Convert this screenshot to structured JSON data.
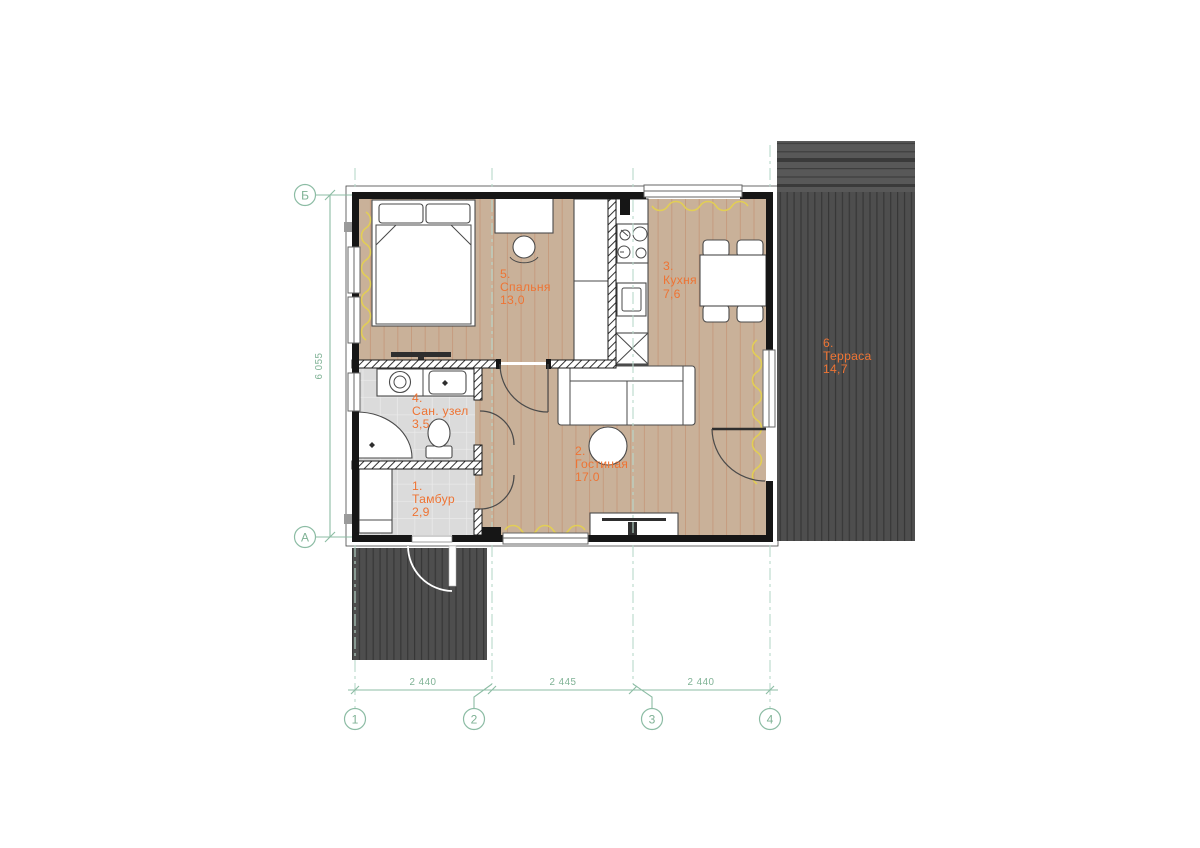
{
  "drawing": {
    "type": "floor-plan",
    "rooms": {
      "vestibule": {
        "number": "1.",
        "name": "Тамбур",
        "area": "2,9"
      },
      "living": {
        "number": "2.",
        "name": "Гостиная",
        "area": "17.0"
      },
      "kitchen": {
        "number": "3.",
        "name": "Кухня",
        "area": "7,6"
      },
      "bathroom": {
        "number": "4.",
        "name": "Сан. узел",
        "area": "3,5"
      },
      "bedroom": {
        "number": "5.",
        "name": "Спальня",
        "area": "13,0"
      },
      "terrace": {
        "number": "6.",
        "name": "Терраса",
        "area": "14,7"
      }
    },
    "axes": {
      "row_top": "Б",
      "row_bottom": "А",
      "col_1": "1",
      "col_2": "2",
      "col_3": "3",
      "col_4": "4"
    },
    "dimensions": {
      "span_1_2": "2 440",
      "span_2_3": "2 445",
      "span_3_4": "2 440",
      "height_left": "6 055"
    },
    "colors": {
      "label_orange": "#EE7434",
      "grid_green": "#8CBCA4",
      "floor_wood": "#C9B199",
      "floor_tile": "#DBDBDB",
      "deck_dark": "#4E4E4E",
      "curtain_yellow": "#E2CE55",
      "wall_black": "#161616"
    }
  }
}
